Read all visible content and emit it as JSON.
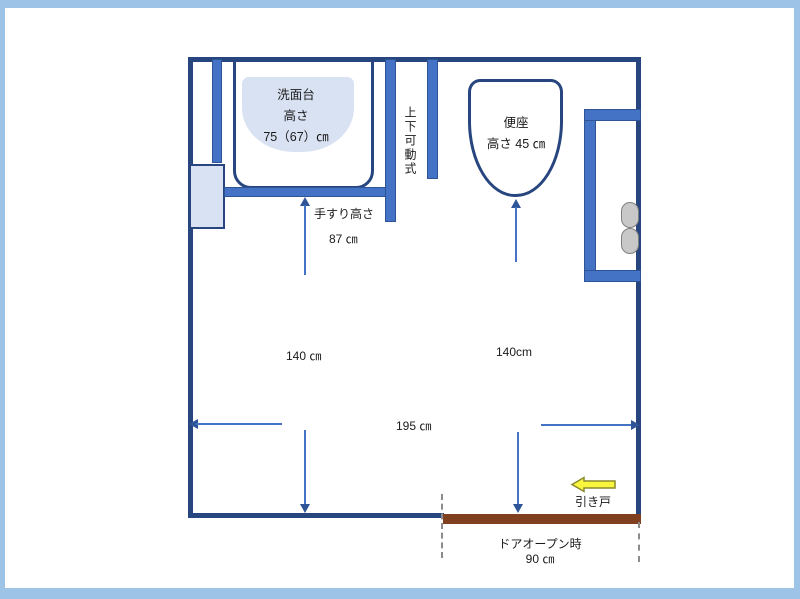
{
  "floor_plan": {
    "washbasin": {
      "name": "洗面台",
      "height_label": "高さ",
      "height_value": "75（67）㎝"
    },
    "adjustable_unit": {
      "label": "上下可動式"
    },
    "toilet": {
      "name": "便座",
      "height": "高さ 45 ㎝"
    },
    "handrail": {
      "label": "手すり高さ",
      "height": "87 ㎝"
    },
    "dimensions": {
      "left_depth": "140 ㎝",
      "right_depth": "140cm",
      "width": "195 ㎝"
    },
    "door": {
      "type_label": "引き戸",
      "open_label": "ドアオープン時",
      "open_width": "90 ㎝"
    },
    "colors": {
      "wall": "#27457E",
      "fixture_blue": "#4472C4",
      "light_fill": "#D9E2F3",
      "door_brown": "#803F1E",
      "direction_arrow_yellow": "#F8F53C",
      "slide_frame": "#9DC3E6",
      "dimension_blue": "#4472C4"
    }
  }
}
